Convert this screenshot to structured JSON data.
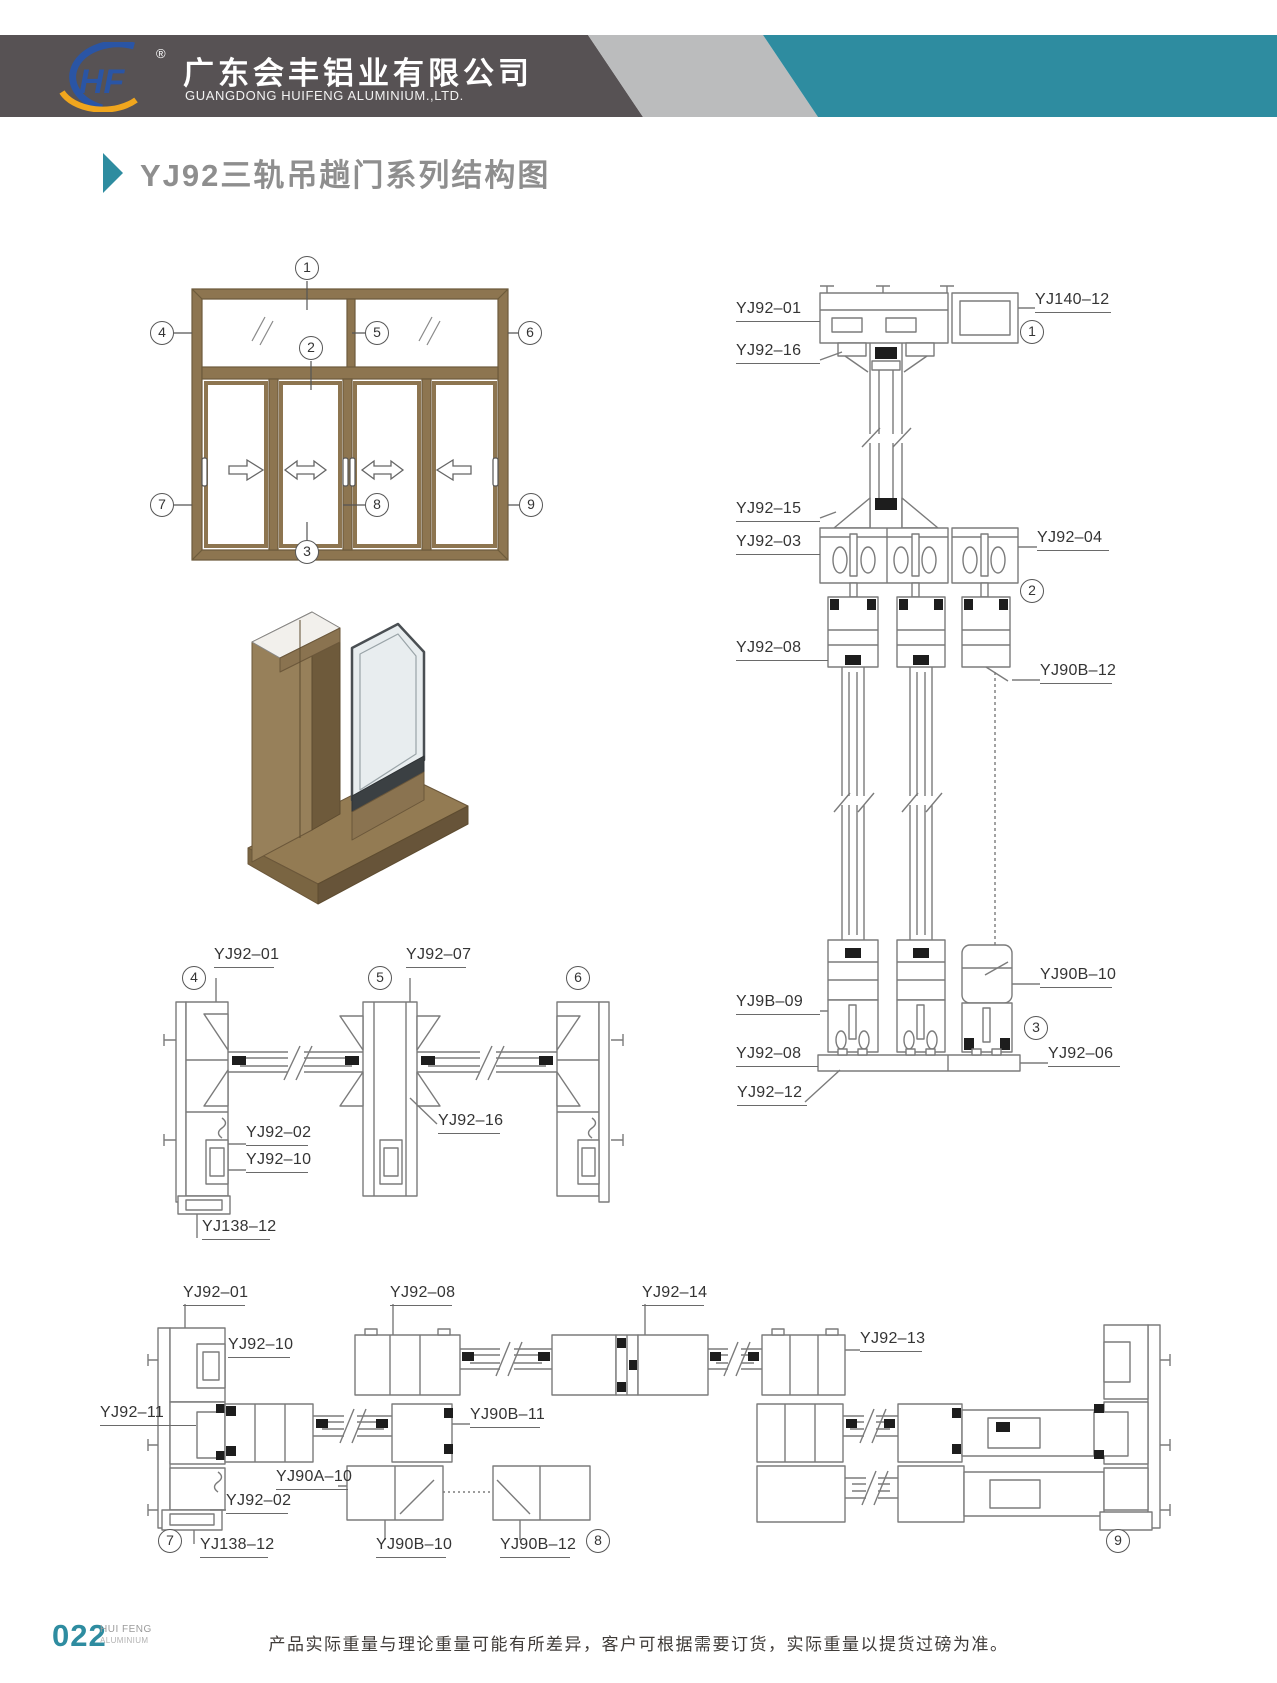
{
  "header": {
    "logo_text": "HF",
    "registered": "®",
    "company_cn": "广东会丰铝业有限公司",
    "company_en": "GUANGDONG HUIFENG ALUMINIUM.,LTD."
  },
  "page_title": "YJ92三轨吊趟门系列结构图",
  "colors": {
    "teal_accent": "#2E8CA0",
    "header_dark_gray": "#575254",
    "header_light_gray": "#BBBCBD",
    "frame_brown": "#8D7550",
    "cad_line_gray": "#7B7B7B"
  },
  "part_labels": {
    "vertical": [
      "YJ92–01",
      "YJ140–12",
      "YJ92–16",
      "YJ92–15",
      "YJ92–03",
      "YJ92–04",
      "YJ92–08",
      "YJ90B–12",
      "YJ90B–10",
      "YJ9B–09",
      "YJ92–08",
      "YJ92–06",
      "YJ92–12"
    ],
    "middle": [
      "YJ92–01",
      "YJ92–07",
      "YJ92–16",
      "YJ92–02",
      "YJ92–10",
      "YJ138–12"
    ],
    "bottom": [
      "YJ92–01",
      "YJ92–10",
      "YJ92–11",
      "YJ92–02",
      "YJ138–12",
      "YJ92–08",
      "YJ90A–10",
      "YJ90B–10",
      "YJ90B–11",
      "YJ90B–12",
      "YJ92–14",
      "YJ92–13"
    ]
  },
  "callouts": {
    "elevation": [
      "1",
      "2",
      "3",
      "4",
      "5",
      "6",
      "7",
      "8",
      "9"
    ],
    "sections": [
      "1",
      "2",
      "3",
      "4",
      "5",
      "6",
      "7",
      "8",
      "9"
    ]
  },
  "footer": {
    "page_number": "022",
    "brand_top": "HUI FENG",
    "brand_bottom": "ALUMINIUM",
    "disclaimer": "产品实际重量与理论重量可能有所差异，客户可根据需要订货，实际重量以提货过磅为准。"
  }
}
